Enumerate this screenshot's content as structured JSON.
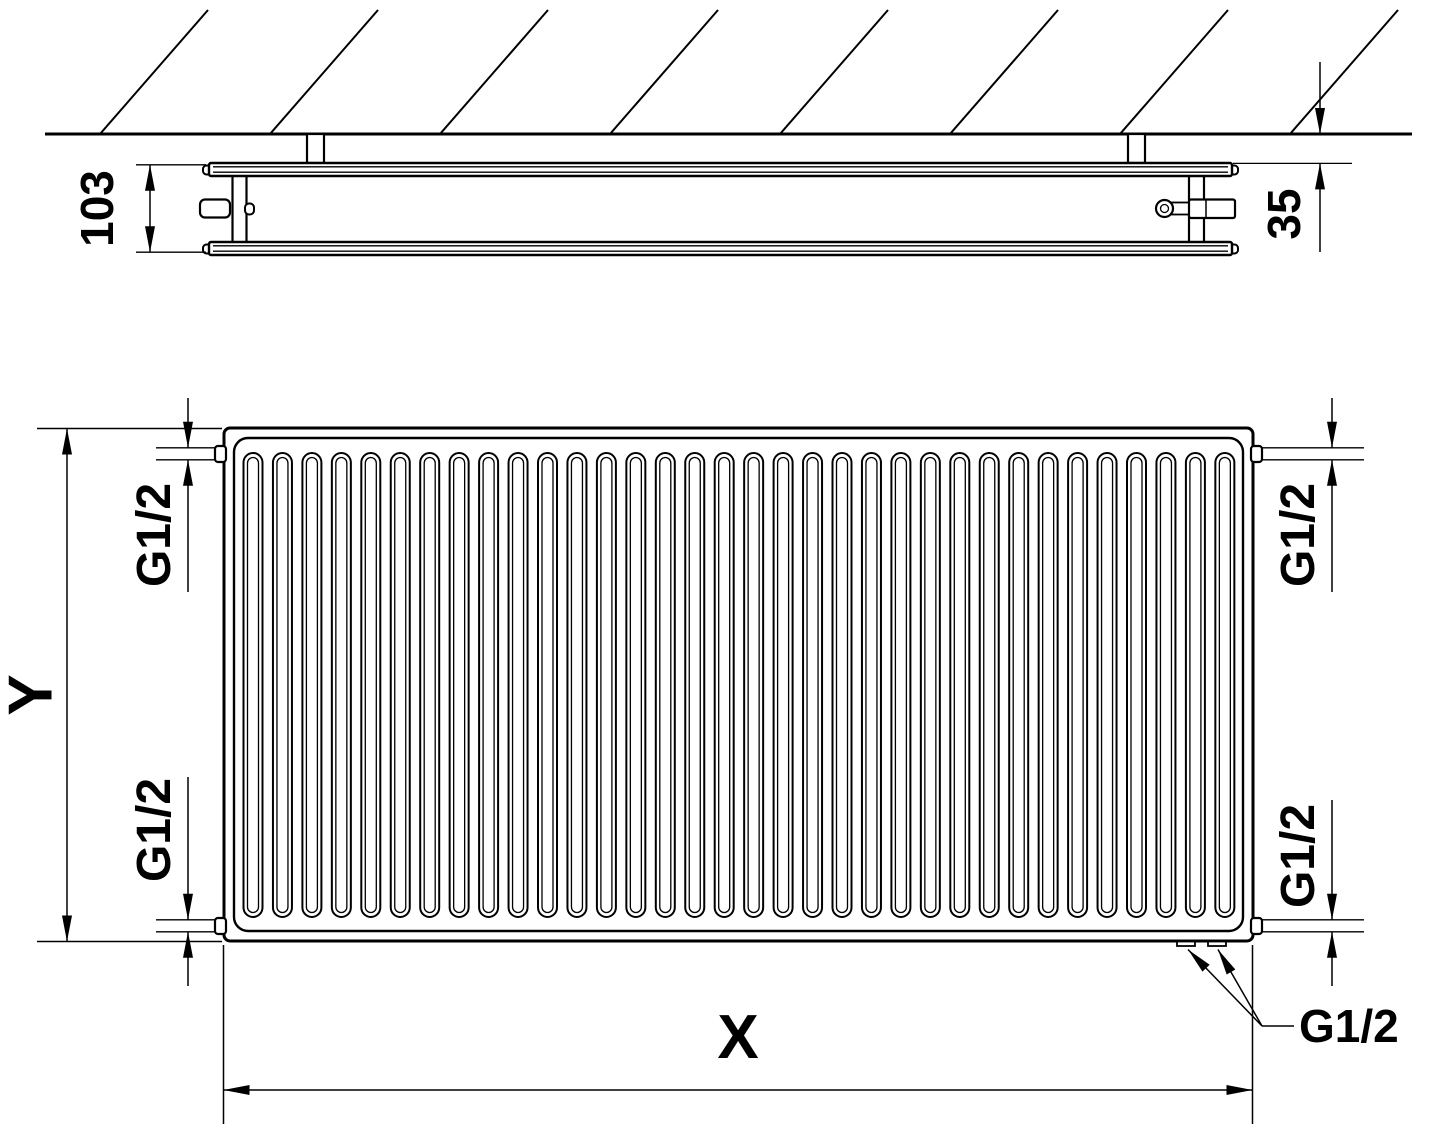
{
  "drawing": {
    "kind": "panel-radiator technical dimension drawing",
    "views": {
      "top_view": {
        "dim_depth": "103",
        "dim_wall_distance": "35"
      },
      "front_view": {
        "dim_height": "Y",
        "dim_width": "X",
        "fins": 34,
        "hatch_lines": 8,
        "connections": {
          "top_left": "G1/2",
          "bottom_left": "G1/2",
          "top_right": "G1/2",
          "bottom_right": "G1/2",
          "bottom_outlets": "G1/2"
        }
      }
    },
    "colors": {
      "line": "#000000",
      "background": "#ffffff"
    }
  }
}
